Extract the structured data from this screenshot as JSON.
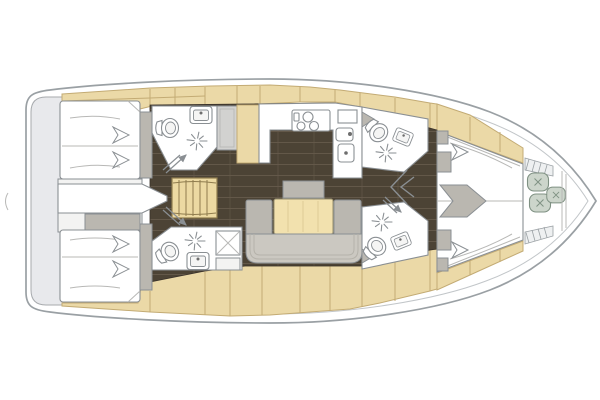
{
  "meta": {
    "description": "Top-down interior layout floor plan of a sailing yacht, bow pointing right",
    "orientation": "bow-right",
    "canvas": {
      "width": 600,
      "height": 400
    }
  },
  "colors": {
    "background": "#ffffff",
    "hull_outline": "#9aa0a4",
    "hull_inner_line": "#c2c6c9",
    "transom_gray": "#e8e9ec",
    "deck_wood": "#ebd9a7",
    "deck_wood_edge": "#c3ab74",
    "floor_walnut": "#4c4335",
    "floor_plank_line": "#635849",
    "furniture_white": "#ffffff",
    "furniture_outline": "#8a8f93",
    "upholstery_gray": "#cbc8c1",
    "upholstery_dark": "#bab7b0",
    "appliance_gray": "#d2d2d0",
    "table_wood": "#f2e1ae",
    "stairs_wood": "#ecd9a2",
    "cushion_sage": "#ccd5cb",
    "cushion_edge": "#7f9183"
  },
  "rooms": [
    {
      "id": "transom-platform"
    },
    {
      "id": "aft-cabin-port"
    },
    {
      "id": "aft-cabin-starboard"
    },
    {
      "id": "aft-head-port"
    },
    {
      "id": "aft-head-starboard"
    },
    {
      "id": "companionway-stairs"
    },
    {
      "id": "galley"
    },
    {
      "id": "salon"
    },
    {
      "id": "fwd-head-port"
    },
    {
      "id": "fwd-head-starboard"
    },
    {
      "id": "forward-cabin"
    },
    {
      "id": "bow-locker"
    }
  ],
  "symbols": {
    "shower": "asterisk-star-spokes",
    "toilet": "oval-bowl-with-tank",
    "sink": "rounded-basin-with-drain-dot",
    "stove": "three-burner-circles",
    "door_swing": "double-line-arrow",
    "pillow": "chevron-arrow",
    "bow_cushions": "rounded-squares-with-cross-stitch",
    "locker_hatch": "diagonal-hatching"
  }
}
